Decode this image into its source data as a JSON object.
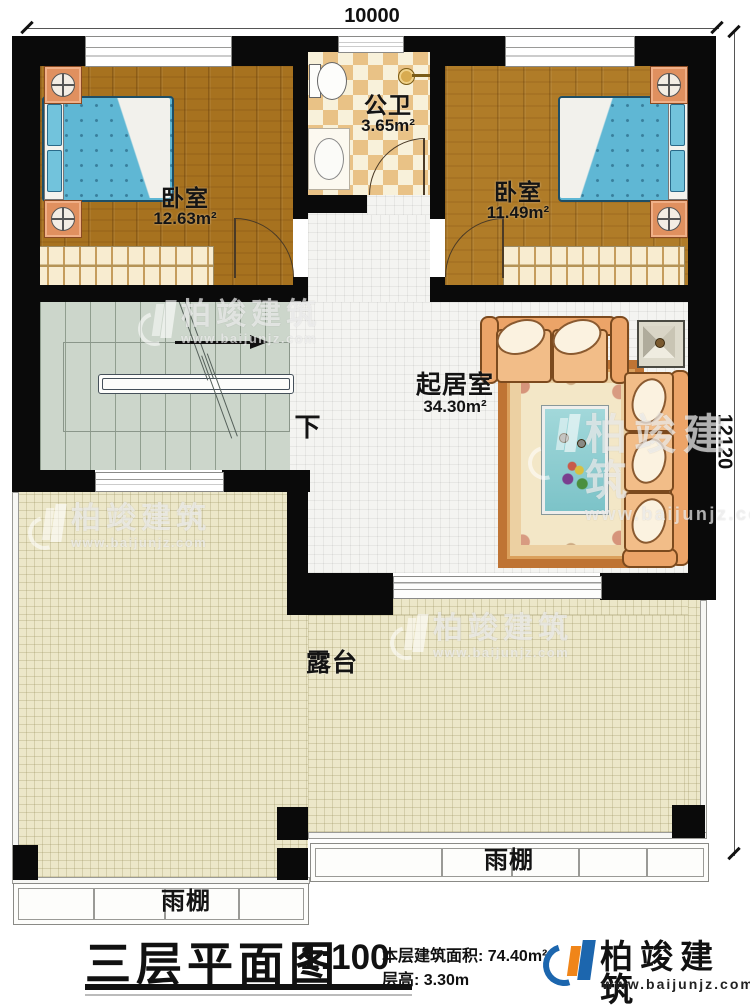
{
  "dimensions": {
    "top": "10000",
    "right": "12120"
  },
  "rooms": {
    "bedroom_left": {
      "name": "卧室",
      "area": "12.63m²"
    },
    "bathroom": {
      "name": "公卫",
      "area": "3.65m²"
    },
    "bedroom_right": {
      "name": "卧室",
      "area": "11.49m²"
    },
    "living": {
      "name": "起居室",
      "area": "34.30m²"
    },
    "terrace": {
      "name": "露台"
    },
    "canopy_left": {
      "name": "雨棚"
    },
    "canopy_right": {
      "name": "雨棚"
    },
    "stairs": {
      "direction_label": "下"
    }
  },
  "titleblock": {
    "title": "三层平面图",
    "scale": "1:100",
    "floor_area": "本层建筑面积: 74.40m²",
    "floor_height": "层高: 3.30m"
  },
  "brand": {
    "name": "柏竣建筑",
    "website": "www.baijunjz.com"
  },
  "watermark": {
    "name": "柏竣建筑",
    "website": "www.baijunjz.com"
  },
  "colors": {
    "wall": "#0a0a0a",
    "wood_floor": "#a7721f",
    "bed_blue": "#5fb7d4",
    "bath_tile": "#e9c286",
    "terrace": "#ece7c9",
    "stair": "#ccd6cb",
    "sofa": "#eca468",
    "logo_blue": "#1c66ae",
    "logo_orange": "#f08519"
  }
}
